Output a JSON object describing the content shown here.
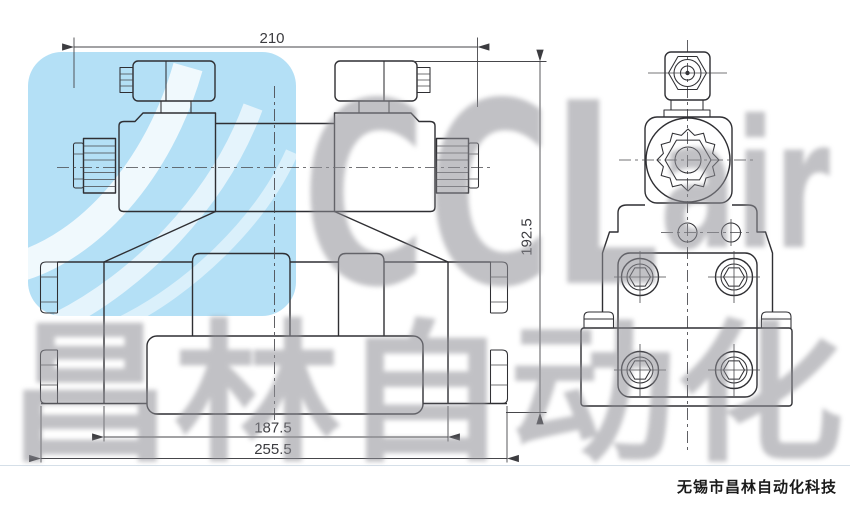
{
  "page": {
    "background": "#ffffff",
    "divider_color": "#d5dfe8"
  },
  "drawing": {
    "type": "engineering-drawing",
    "views": [
      {
        "id": "front-view",
        "description": "double solenoid directional valve, front elevation"
      },
      {
        "id": "side-view",
        "description": "valve side elevation with socket-head mounting bolts"
      }
    ],
    "line_color": "#2f2f33",
    "dimensions": {
      "top_width": "210",
      "overall_height": "192.5",
      "body_width": "187.5",
      "overall_width": "255.5"
    }
  },
  "watermark": {
    "brand_main": "CCL",
    "brand_sub": "air",
    "chinese": "昌林自动化",
    "logo_color": "#b4e0f6",
    "text_color": "#8f8f96"
  },
  "footer": {
    "company": "无锡市昌林自动化科技"
  }
}
